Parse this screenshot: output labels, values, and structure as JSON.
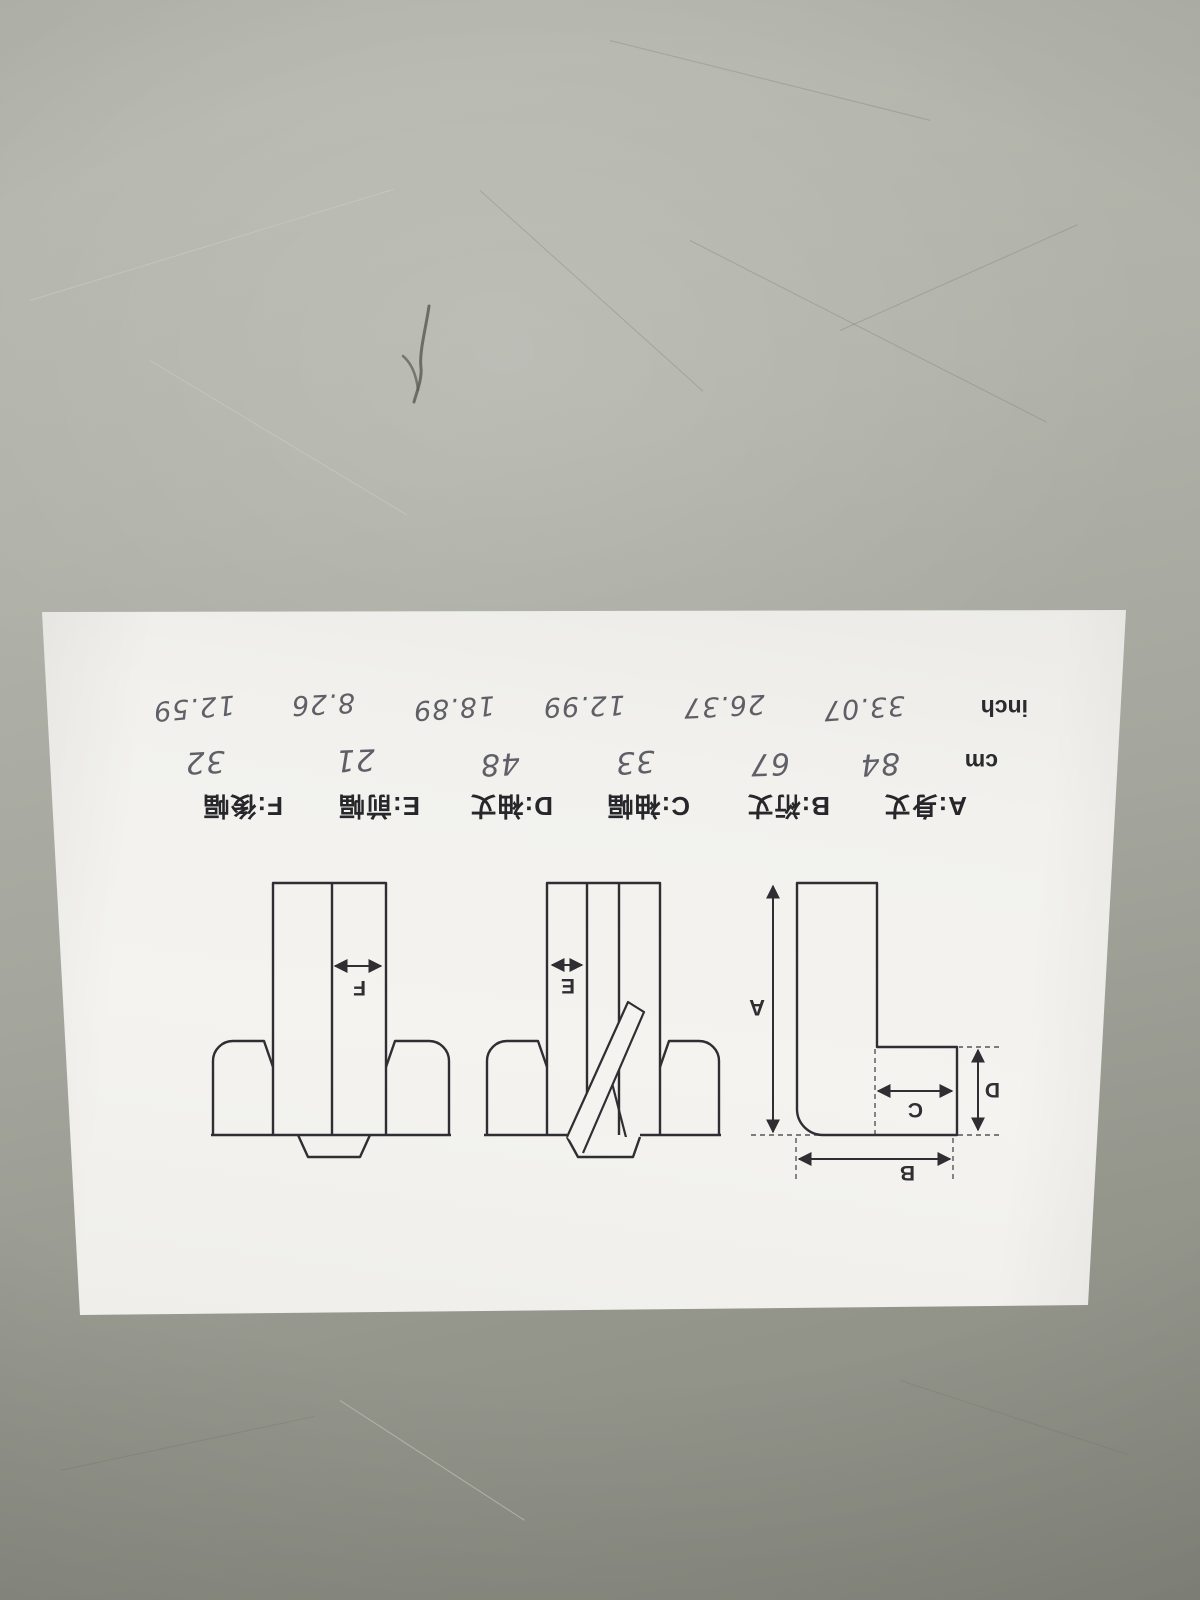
{
  "sheet": {
    "size_chart": {
      "labels": [
        "A:身丈",
        "B:裄丈",
        "C:袖幅",
        "D:袖丈",
        "E:前幅",
        "F:後幅"
      ],
      "cm": {
        "unit": "cm",
        "values": [
          "84",
          "67",
          "33",
          "48",
          "21",
          "32"
        ]
      },
      "inch": {
        "unit": "inch",
        "values": [
          "33.07",
          "26.37",
          "12.99",
          "18.89",
          "8.26",
          "12.59"
        ]
      }
    },
    "diagram_letters": [
      "A",
      "B",
      "C",
      "D",
      "E",
      "F"
    ]
  },
  "colors": {
    "desk_gray": "#a9aba2",
    "paper_white": "#f2f1ed",
    "ink_black": "#2e2e33",
    "handwriting_gray": "#4b4b55"
  }
}
